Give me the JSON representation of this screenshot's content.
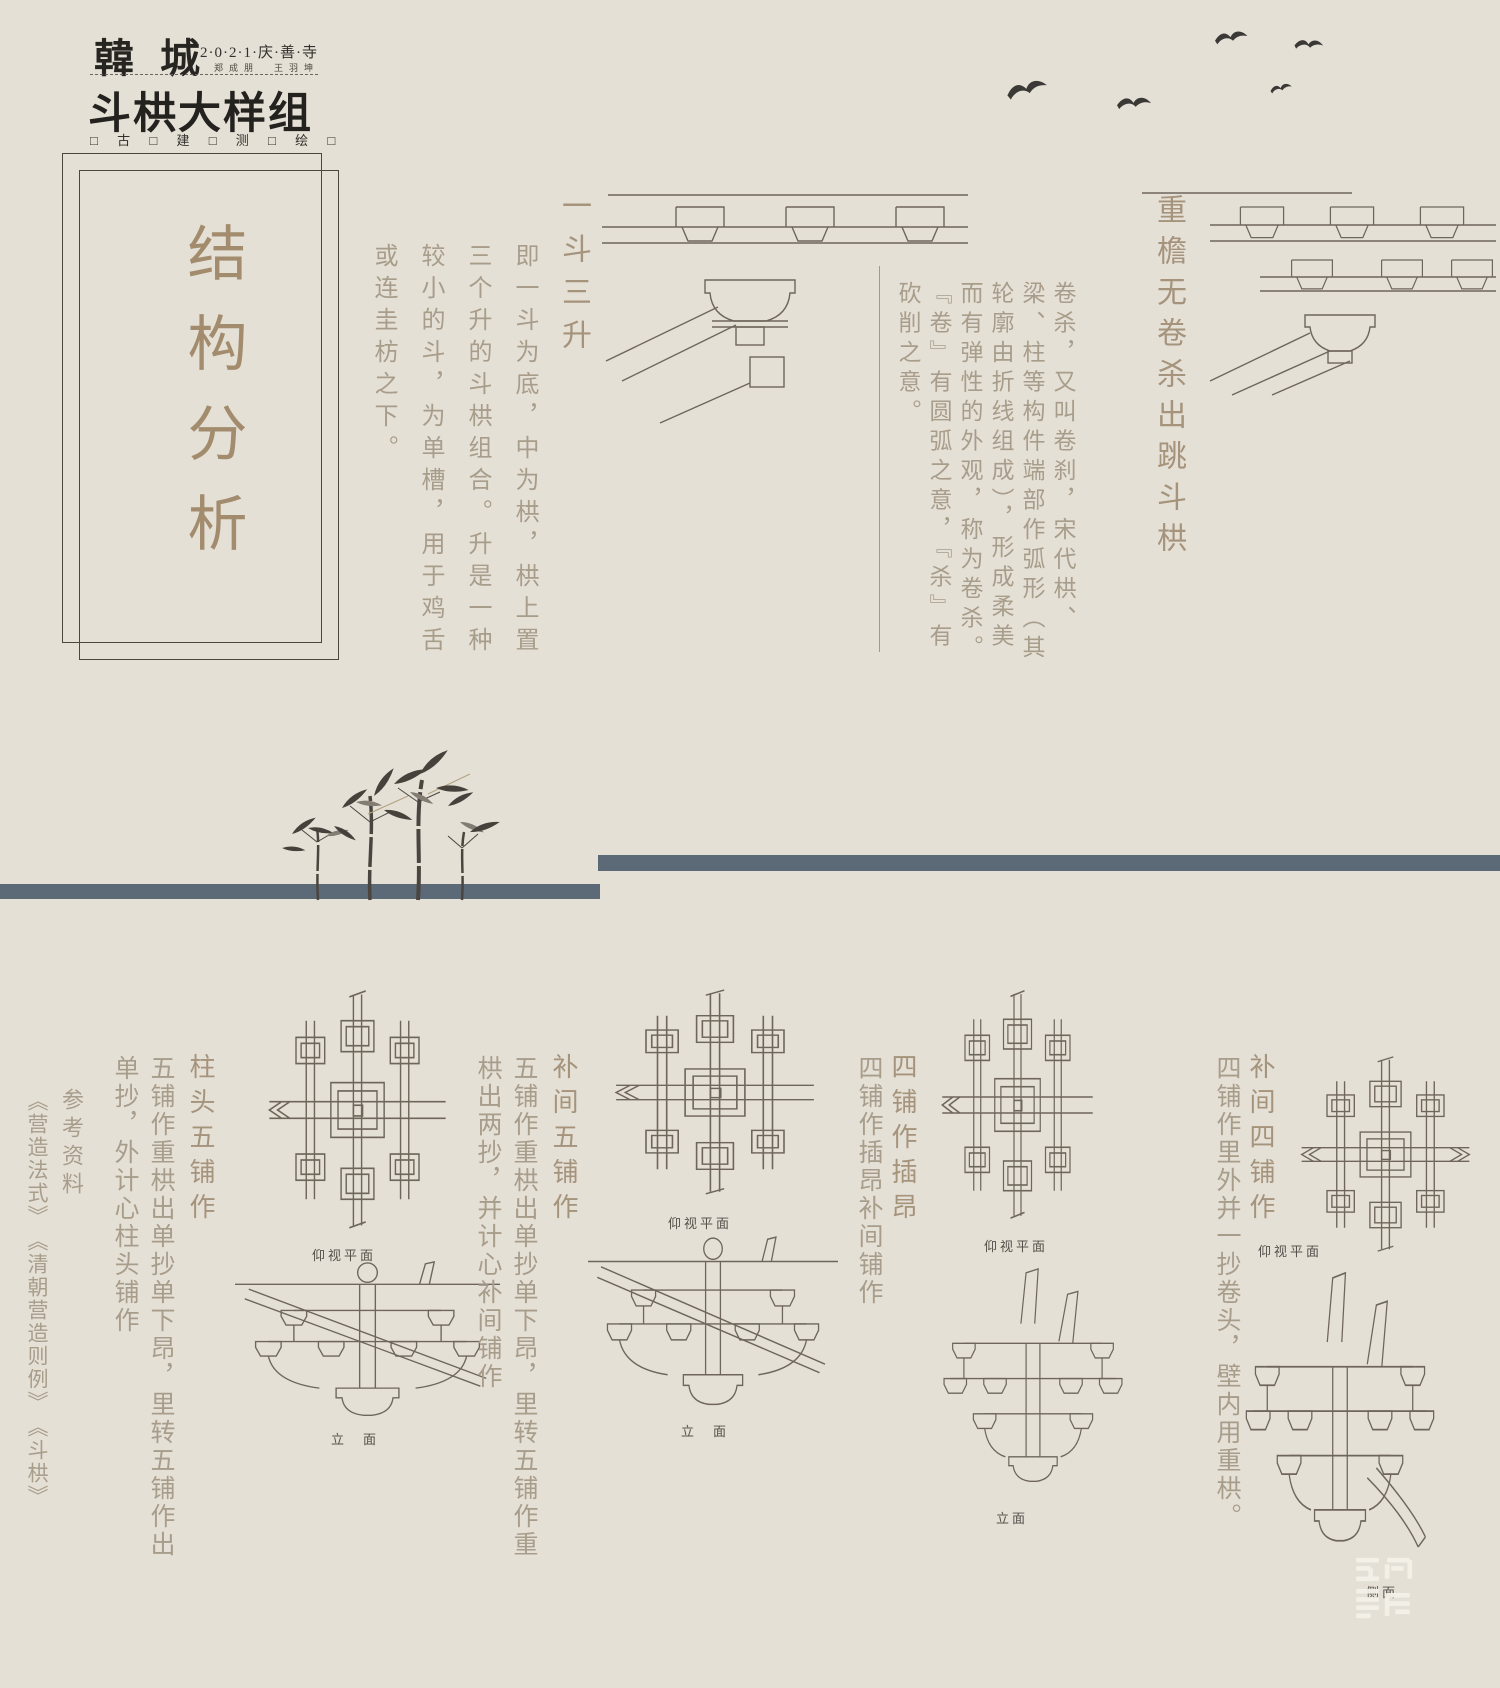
{
  "header": {
    "brand": "韓城",
    "date": "2·0·2·1·庆·善·寺",
    "authors": "郑成朋　王羽坤",
    "title": "斗栱大样组",
    "motto": "□ 古 □ 建 □ 测 □ 绘 □"
  },
  "main_title": "结构分析",
  "sections": [
    {
      "title": "一斗三升",
      "body": "即一斗为底，中为栱，栱上置三个升的斗栱组合。升是一种较小的斗，为单槽，用于鸡舌或连圭枋之下。"
    },
    {
      "title": "重檐无卷杀出跳斗栱",
      "body": "卷杀，又叫卷刹，宋代栱、梁、柱等构件端部作弧形（其轮廓由折线组成），形成柔美而有弹性的外观，称为卷杀。『卷』有圆弧之意，『杀』有砍削之意。"
    }
  ],
  "groups": [
    {
      "title": "柱头五铺作",
      "body": "五铺作重栱出单抄单下昂，里转五铺作出单抄，外计心柱头铺作",
      "plan_label": "仰视平面",
      "elev_label": "立　面"
    },
    {
      "title": "补间五铺作",
      "body": "五铺作重栱出单抄单下昂，里转五铺作重栱出两抄，并计心补间铺作",
      "plan_label": "仰视平面",
      "elev_label": "立　面"
    },
    {
      "title": "四铺作插昂",
      "body": "四铺作插昂补间铺作",
      "plan_label": "仰视平面",
      "elev_label": "立面"
    },
    {
      "title": "补间四铺作",
      "body": "四铺作里外并一抄卷头，壁内用重栱。",
      "plan_label": "仰视平面",
      "elev_label": "侧面"
    }
  ],
  "references": {
    "label": "参考资料",
    "books": "《营造法式》　《清朝营造则例》　《斗栱》"
  }
}
